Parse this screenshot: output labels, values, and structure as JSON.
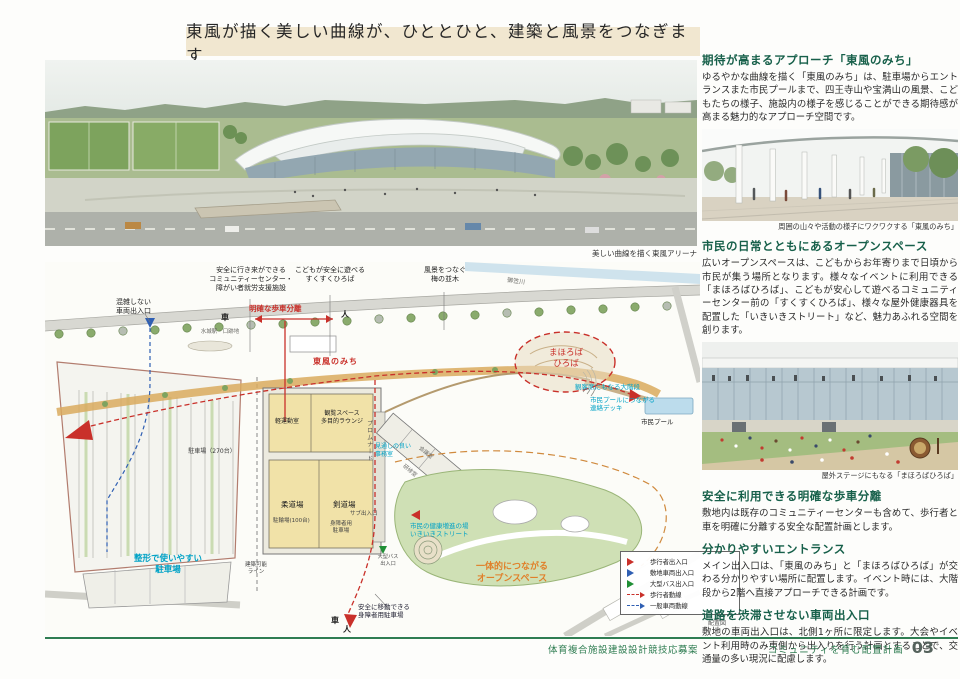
{
  "header": {
    "title": "東風が描く美しい曲線が、ひととひと、建築と風景をつなぎます"
  },
  "aerial": {
    "caption": "美しい曲線を描く東風アリーナ"
  },
  "right_column": {
    "sections": [
      {
        "heading": "期待が高まるアプローチ「東風のみち」",
        "body": "ゆるやかな曲線を描く「東風のみち」は、駐車場からエントランスまた市民プールまで、四王寺山や宝満山の風景、こどもたちの様子、施設内の様子を感じることができる期待感が高まる魅力的なアプローチ空間です。",
        "caption": "周囲の山々や活動の様子にワクワクする「東風のみち」"
      },
      {
        "heading": "市民の日常とともにあるオープンスペース",
        "body": "広いオープンスペースは、こどもからお年寄りまで日頃から市民が集う場所となります。様々なイベントに利用できる「まほろばひろば」、こどもが安心して遊べるコミュニティーセンター前の「すくすくひろば」、様々な屋外健康器具を配置した「いきいきストリート」など、魅力あふれる空間を創ります。",
        "caption": "屋外ステージにもなる「まほろばひろば」"
      },
      {
        "heading": "安全に利用できる明確な歩車分離",
        "body": "敷地内は既存のコミュニティーセンターも含めて、歩行者と車を明確に分離する安全な配置計画とします。"
      },
      {
        "heading": "分かりやすいエントランス",
        "body": "メイン出入口は、「東風のみち」と「まほろばひろば」が交わる分かりやすい場所に配置します。イベント時には、大階段から2階へ直接アプローチできる計画です。"
      },
      {
        "heading": "道路を渋滞させない車両出入口",
        "body": "敷地の車両出入口は、北側1ヶ所に限定します。大会やイベント利用時のみ東側から出入りを行う計画とすることで、交通量の多い現況に配慮します。"
      }
    ]
  },
  "siteplan": {
    "labels": {
      "congestion": "混雑しない\n車両出入口",
      "community_center": "安全に行き来ができる\nコミュニティーセンター・\n障がい者就労支援施設",
      "pedestrian_separation": "明確な歩車分離",
      "car_top": "車",
      "person_top": "人",
      "mizuki_station": "水城駅・口跡地",
      "sukusuku": "こどもが安全に遊べる\nすくすくひろば",
      "plum_trees": "風景をつなぐ\n梅の並木",
      "mikasa_river": "御笠川",
      "kochi_no_michi": "東風のみち",
      "mahoroba": "まほろば\nひろば",
      "grand_stairs": "観客席にもなる大階段",
      "pool_deck": "市民プールにつながる\n連絡デッキ",
      "civic_pool": "市民プール",
      "light_exercise": "軽運動室",
      "lounge": "観覧スペース\n多目的ラウンジ",
      "judo": "柔道場",
      "kendo": "剣道場",
      "meeting": "会議室",
      "training": "研修室",
      "office_view": "見通しの良い\n事務室",
      "promenade": "プロムナード",
      "sub_entrance": "サブ出入口",
      "bicycle": "駐輪場(100台)",
      "disabled_parking_small": "身障者用\n駐車場",
      "parking_count": "駐車場（270台）",
      "shapely_parking": "整形で使いやすい\n駐車場",
      "buildable_line": "建築可能\nライン",
      "bus_entrance": "大型バス\n出入口",
      "iki_iki": "市民の健康増進の場\nいきいきストリート",
      "open_space": "一体的につながる\nオープンスペース",
      "safe_disabled_parking": "安全に移動できる\n身障者用駐車場",
      "car_bottom": "車",
      "person_bottom": "人"
    },
    "legend": {
      "items": [
        {
          "label": "歩行者出入口",
          "marker": "triangle",
          "color": "#c9302a"
        },
        {
          "label": "敷地車両出入口",
          "marker": "triangle",
          "color": "#2f5fb3"
        },
        {
          "label": "大型バス出入口",
          "marker": "triangle",
          "color": "#1f8f35"
        },
        {
          "label": "歩行者動線",
          "marker": "dashed-arrow",
          "color": "#c9302a"
        },
        {
          "label": "一般車両動線",
          "marker": "dashed-arrow",
          "color": "#2f5fb3"
        }
      ],
      "caption": "配置図"
    }
  },
  "footer": {
    "project": "体育複合施設建設設計競技応募案",
    "section": "コミュニティを育む配置計画",
    "page_number": "03"
  },
  "colors": {
    "header_band": "#f1e7d0",
    "heading_green": "#17604a",
    "footer_green": "#2f7d52",
    "callout_cyan": "#00a2c6",
    "accent_red": "#c9302a",
    "accent_orange": "#e0802a",
    "path_tan": "#d9aa5e"
  }
}
